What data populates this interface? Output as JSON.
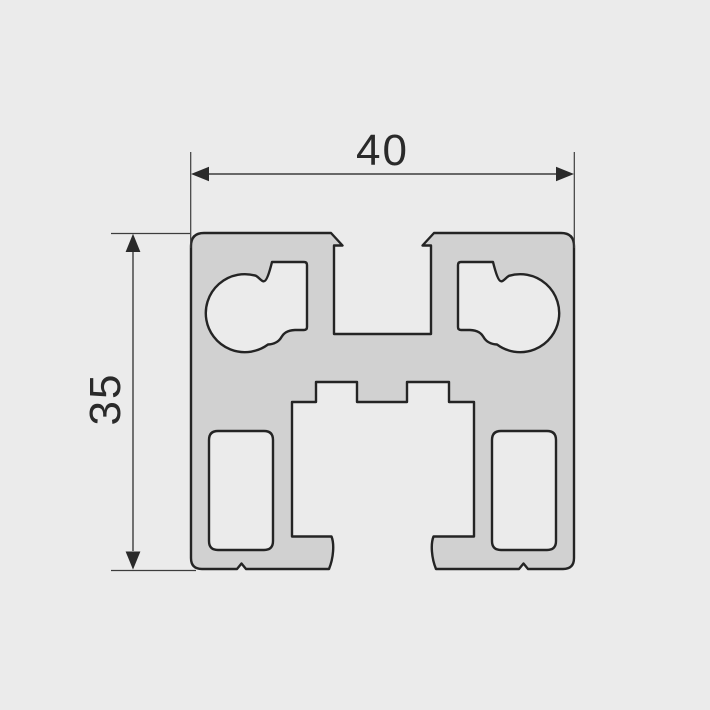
{
  "drawing": {
    "kind": "technical-cross-section",
    "subject": "aluminum-extrusion-profile",
    "dimensions": {
      "width": {
        "value": "40",
        "orientation": "horizontal",
        "units_shown": false
      },
      "height": {
        "value": "35",
        "orientation": "vertical",
        "units_shown": false
      }
    },
    "features": {
      "screw_channels": 2,
      "t_slot_top": 1,
      "bottom_cavity_notches": 2,
      "rounded_rect_holes": 2,
      "bottom_edge_marker_notches": 2
    },
    "colors": {
      "background": "#ebebeb",
      "material_fill": "#d1d1d1",
      "outline": "#242424",
      "dimension_lines": "#3d3d3d",
      "dimension_text": "#2a2a2a"
    }
  }
}
